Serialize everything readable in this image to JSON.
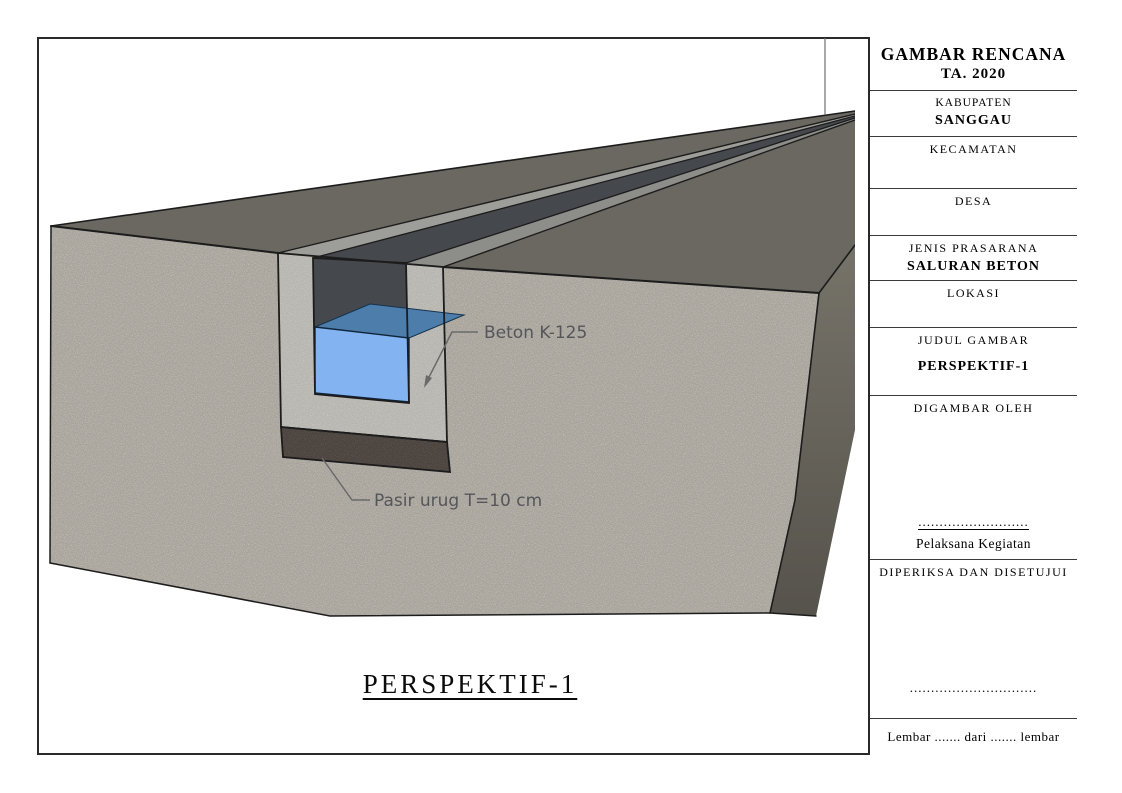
{
  "drawing": {
    "view_title": "PERSPEKTIF-1",
    "annotations": {
      "concrete": "Beton K-125",
      "sand": "Pasir urug T=10 cm"
    },
    "colors": {
      "ground": "#a7a39b",
      "concrete": "#b6b4ae",
      "sand": "#4a423d",
      "top_surface": "#6a6861",
      "side_top": "#767369",
      "side_bottom": "#56534c",
      "wall_top_left": "#9d9d99",
      "wall_top_right": "#8d8d89",
      "channel_opening": "#45484c",
      "water_front": "#83b4f1",
      "water_top": "#4d7dab",
      "outline": "#1c1c1c",
      "leader": "#6a6a6a"
    }
  },
  "title_block": {
    "header": {
      "line1": "GAMBAR RENCANA",
      "line2": "TA. 2020"
    },
    "kabupaten": {
      "label": "KABUPATEN",
      "value": "SANGGAU"
    },
    "kecamatan": {
      "label": "KECAMATAN",
      "value": ""
    },
    "desa": {
      "label": "DESA",
      "value": ""
    },
    "jenis": {
      "label": "JENIS PRASARANA",
      "value": "SALURAN BETON"
    },
    "lokasi": {
      "label": "LOKASI",
      "value": ""
    },
    "judul": {
      "label": "JUDUL GAMBAR",
      "value": "PERSPEKTIF-1"
    },
    "digambar": {
      "label": "DIGAMBAR OLEH",
      "dots": "..........................",
      "caption": "Pelaksana Kegiatan"
    },
    "diperiksa": {
      "label": "DIPERIKSA DAN DISETUJUI",
      "dots": ".............................."
    },
    "footer": "Lembar ....... dari ....... lembar"
  }
}
